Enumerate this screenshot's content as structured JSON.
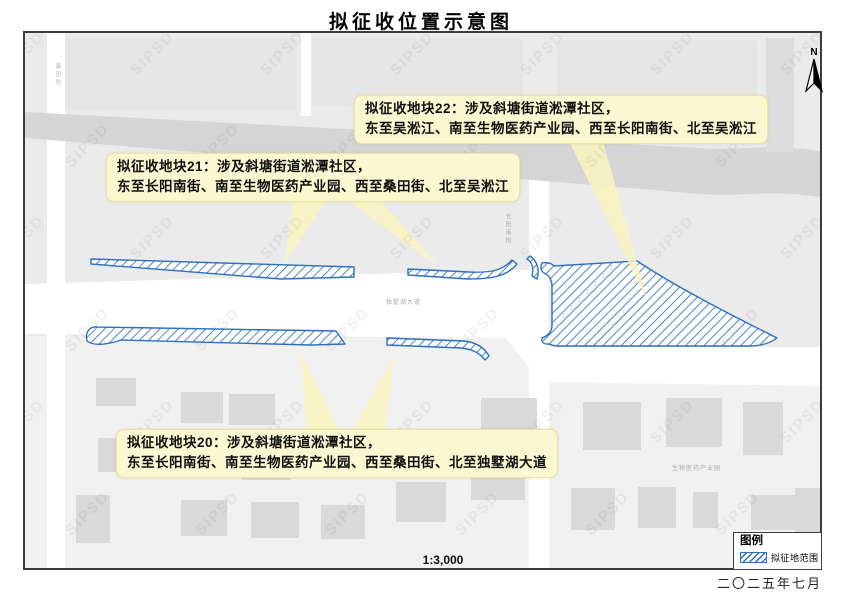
{
  "title": "拟征收位置示意图",
  "date_label": "二〇二五年七月",
  "scale_label": "1:3,000",
  "north_label": "N",
  "watermark": "SIPSD",
  "legend": {
    "title": "图例",
    "items": [
      {
        "label": "拟征地范围",
        "swatch": "blue-diagonal-hatch"
      }
    ]
  },
  "callouts": [
    {
      "id": "plot-22",
      "line1": "拟征收地块22：涉及斜塘街道淞潭社区，",
      "line2": "东至吴淞江、南至生物医药产业园、西至长阳南街、北至吴淞江"
    },
    {
      "id": "plot-21",
      "line1": "拟征收地块21：涉及斜塘街道淞潭社区，",
      "line2": "东至长阳南街、南至生物医药产业园、西至桑田街、北至吴淞江"
    },
    {
      "id": "plot-20",
      "line1": "拟征收地块20：涉及斜塘街道淞潭社区，",
      "line2": "东至长阳南街、南至生物医药产业园、西至桑田街、北至独墅湖大道"
    }
  ],
  "road_labels": {
    "mid": "独墅湖大道",
    "west_vertical": "桑田街",
    "center_vertical": "长阳南街",
    "south_area": "生物医药产业园"
  },
  "colors": {
    "hatch_blue": "#2E6FC0",
    "callout_bg": "#FAF8D0",
    "beam": "#F9F4C2",
    "map_bg": "#ebebeb",
    "parcel": "#e6e6e6",
    "lower_ground": "#f1f1f1",
    "road": "#ffffff",
    "river": "#d5d5d5",
    "top_band": "#dddddd",
    "building": "#d9d9d9"
  },
  "map_geometry": {
    "parcels": [
      [
        64,
        38,
        232,
        72
      ],
      [
        306,
        38,
        216,
        68
      ],
      [
        556,
        40,
        200,
        66
      ]
    ],
    "lower_ground": "M24,336 L505,338 L540,382 L819,386 L819,568 L24,568 Z",
    "roads": [
      "M24,284 L505,270 L528,270 L528,347 L819,347 L819,386 L540,382 L505,338 L24,334 Z",
      "M46,33 L64,33 L64,568 L46,568 Z",
      "M528,170 L548,170 L548,568 L528,568 Z",
      "M300,33 L310,33 L310,116 L300,116 Z"
    ],
    "river": "M24,112 L700,148 C745,151 765,143 819,151 L819,197 C765,189 745,197 700,194 L24,138 Z",
    "top_band": [
      765,
      38,
      28,
      114
    ],
    "buildings": [
      [
        95,
        378,
        40,
        28
      ],
      [
        180,
        392,
        42,
        31
      ],
      [
        228,
        394,
        46,
        31
      ],
      [
        97,
        438,
        40,
        34
      ],
      [
        160,
        442,
        50,
        36
      ],
      [
        240,
        444,
        50,
        36
      ],
      [
        310,
        446,
        44,
        32
      ],
      [
        75,
        495,
        34,
        48
      ],
      [
        180,
        500,
        46,
        36
      ],
      [
        250,
        502,
        48,
        36
      ],
      [
        320,
        505,
        44,
        34
      ],
      [
        395,
        482,
        50,
        40
      ],
      [
        480,
        398,
        56,
        46
      ],
      [
        582,
        402,
        58,
        48
      ],
      [
        665,
        398,
        56,
        49
      ],
      [
        742,
        402,
        40,
        53
      ],
      [
        470,
        460,
        54,
        40
      ],
      [
        570,
        488,
        44,
        42
      ],
      [
        637,
        487,
        38,
        41
      ],
      [
        692,
        492,
        25,
        36
      ],
      [
        750,
        495,
        44,
        35
      ],
      [
        794,
        488,
        25,
        70
      ]
    ],
    "hatched": [
      "M90,259 L353,267 L353,277 L280,279 L90,264 Z",
      "M407,269 L468,272 C492,273 502,270 511,260 L516,264 C506,276 492,279 467,279 L407,275 Z",
      "M529,256 C536,261 539,269 536,279 L531,276 C533,268 531,262 526,259 Z",
      "M553,266 L636,261 C680,290 740,320 776,338 C768,344 758,346 748,346 L556,346 C553,346 550,344 546,344 C542,344 540,341 541,338 C547,336 551,331 551,326 L551,286 C551,280 548,275 543,273 C540,271 539,267 541,263 C546,262 550,263 553,266 Z",
      "M86,341 C84,333 88,326 96,327 L335,331 L344,344 L310,345 L120,340 C108,344 94,347 86,341 Z",
      "M386,338 L462,341 C475,342 483,347 488,356 L484,360 C478,352 470,349 460,348 L386,345 Z"
    ],
    "beams": [
      "M292,199 L326,199 L284,263 Z",
      "M345,199 L378,199 L440,269 Z",
      "M568,141 L602,141 L646,300 Z",
      "M306,431 L338,431 L299,349 Z",
      "M352,431 L384,431 L393,355 Z"
    ]
  }
}
